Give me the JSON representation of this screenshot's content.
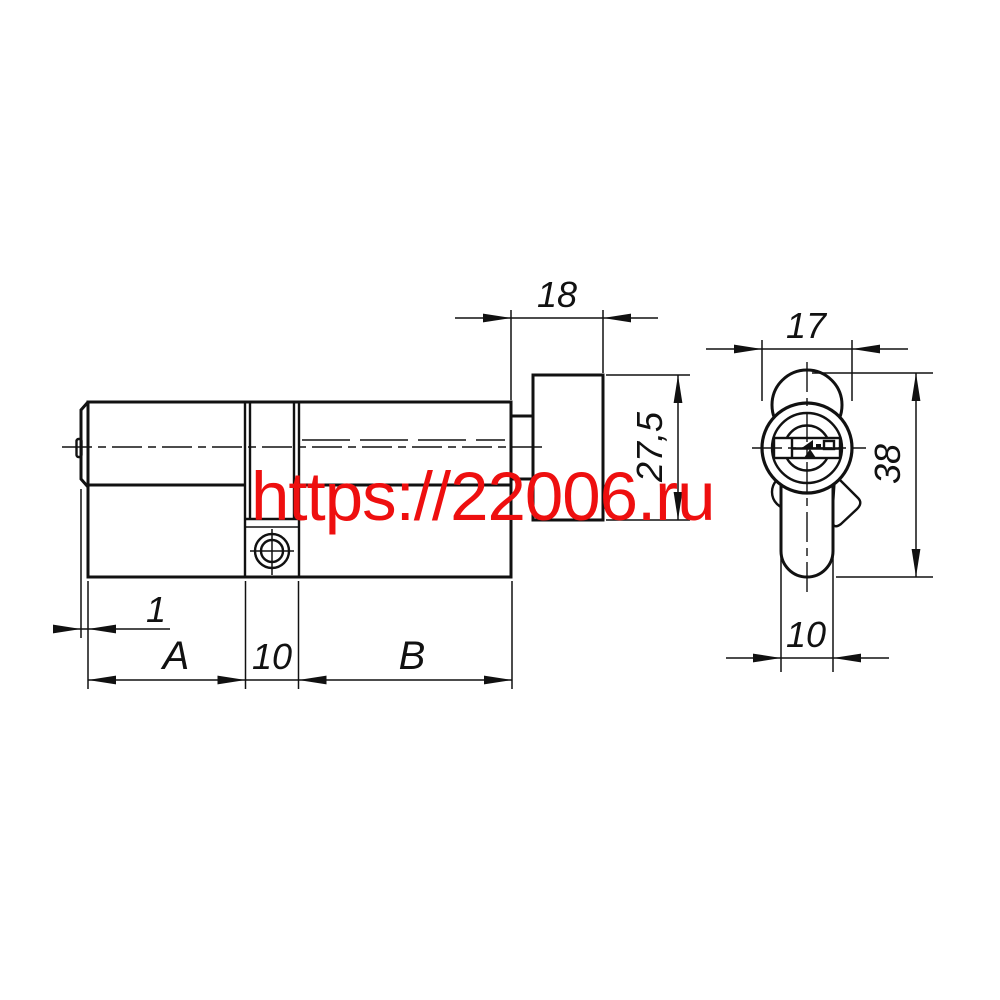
{
  "dimensions": {
    "knob_length": "18",
    "knob_diameter": "27,5",
    "chamfer": "1",
    "section_a": "A",
    "cam_width": "10",
    "section_b": "B",
    "end_width": "17",
    "end_height": "38",
    "end_body_width": "10"
  },
  "watermark": {
    "text": "https://22006.ru",
    "color": "#ee0f0f"
  },
  "line_color": "#111111"
}
